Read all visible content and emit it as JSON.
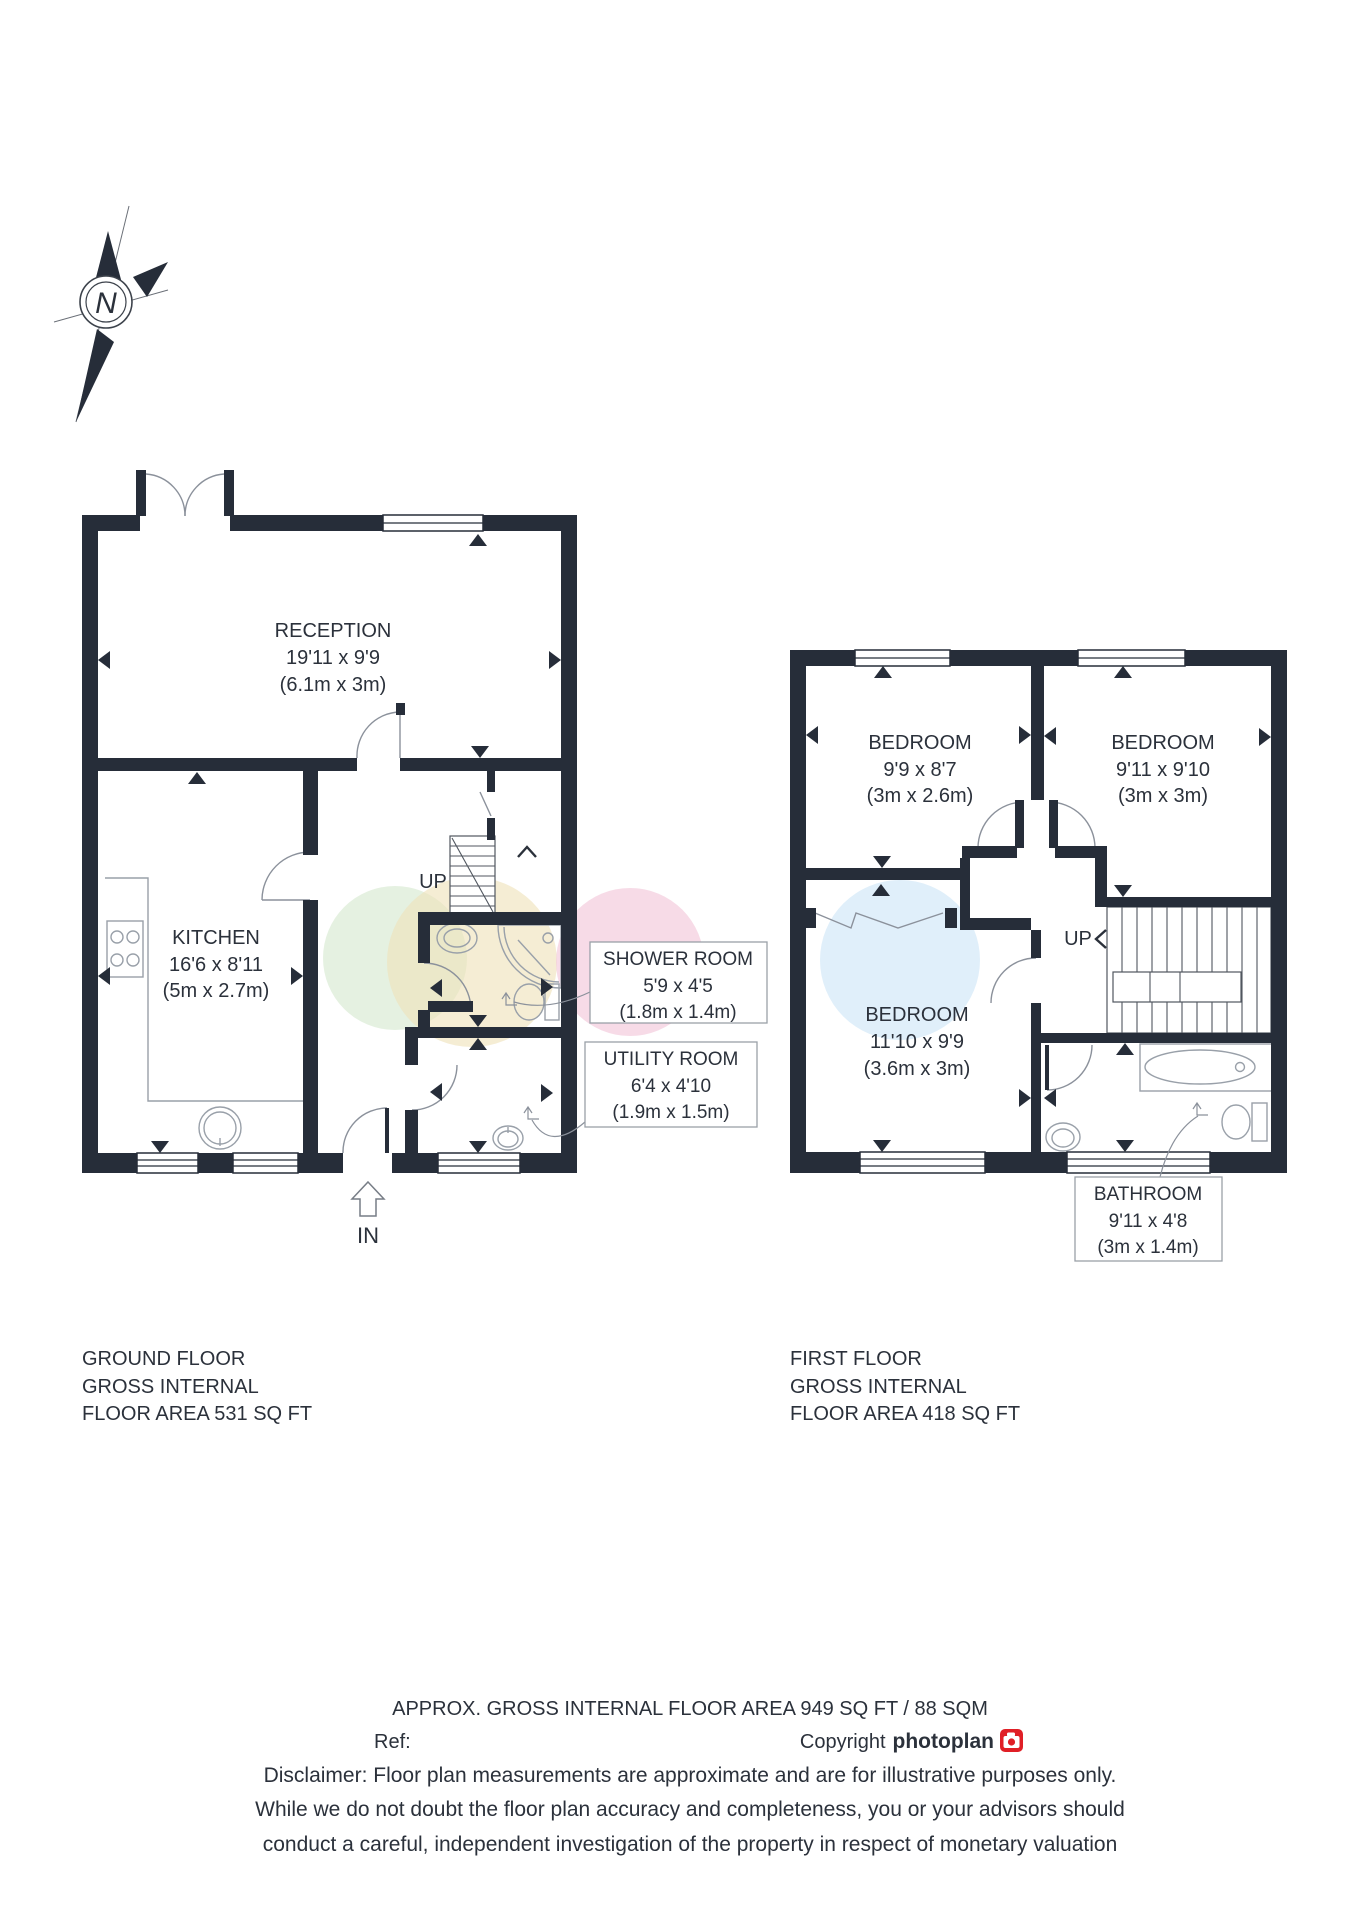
{
  "compass": {
    "letter": "N"
  },
  "colors": {
    "wall": "#262d39",
    "tint_green": "#d5e8cf",
    "tint_yellow": "#efe2ba",
    "tint_pink": "#f3cadb",
    "tint_blue": "#d5eaf8",
    "brand_red": "#e01f26"
  },
  "ground_floor": {
    "caption_lines": [
      "GROUND FLOOR",
      "GROSS INTERNAL",
      "FLOOR AREA 531 SQ FT"
    ],
    "up_label": "UP",
    "entrance_label": "IN",
    "rooms": {
      "reception": {
        "name": "RECEPTION",
        "imperial": "19'11 x 9'9",
        "metric": "(6.1m x 3m)"
      },
      "kitchen": {
        "name": "KITCHEN",
        "imperial": "16'6 x 8'11",
        "metric": "(5m x 2.7m)"
      },
      "shower_room": {
        "name": "SHOWER ROOM",
        "imperial": "5'9 x 4'5",
        "metric": "(1.8m x 1.4m)"
      },
      "utility_room": {
        "name": "UTILITY ROOM",
        "imperial": "6'4 x 4'10",
        "metric": "(1.9m x 1.5m)"
      }
    }
  },
  "first_floor": {
    "caption_lines": [
      "FIRST FLOOR",
      "GROSS INTERNAL",
      "FLOOR AREA 418 SQ FT"
    ],
    "up_label": "UP",
    "rooms": {
      "bedroom_1": {
        "name": "BEDROOM",
        "imperial": "9'9 x 8'7",
        "metric": "(3m x 2.6m)"
      },
      "bedroom_2": {
        "name": "BEDROOM",
        "imperial": "9'11 x 9'10",
        "metric": "(3m x 3m)"
      },
      "bedroom_3": {
        "name": "BEDROOM",
        "imperial": "11'10 x 9'9",
        "metric": "(3.6m x 3m)"
      },
      "bathroom": {
        "name": "BATHROOM",
        "imperial": "9'11 x 4'8",
        "metric": "(3m x 1.4m)"
      }
    }
  },
  "footer": {
    "approx_area_line": "APPROX. GROSS INTERNAL FLOOR AREA 949 SQ FT / 88 SQM",
    "ref_label": "Ref:",
    "copyright_prefix": "Copyright",
    "brand_name": "photoplan",
    "disclaimer_lines": [
      "Disclaimer: Floor plan measurements are approximate and are for illustrative purposes only.",
      "While we do not doubt the floor plan accuracy and completeness, you or your advisors should",
      "conduct a careful, independent investigation of the property in respect of monetary valuation"
    ]
  }
}
